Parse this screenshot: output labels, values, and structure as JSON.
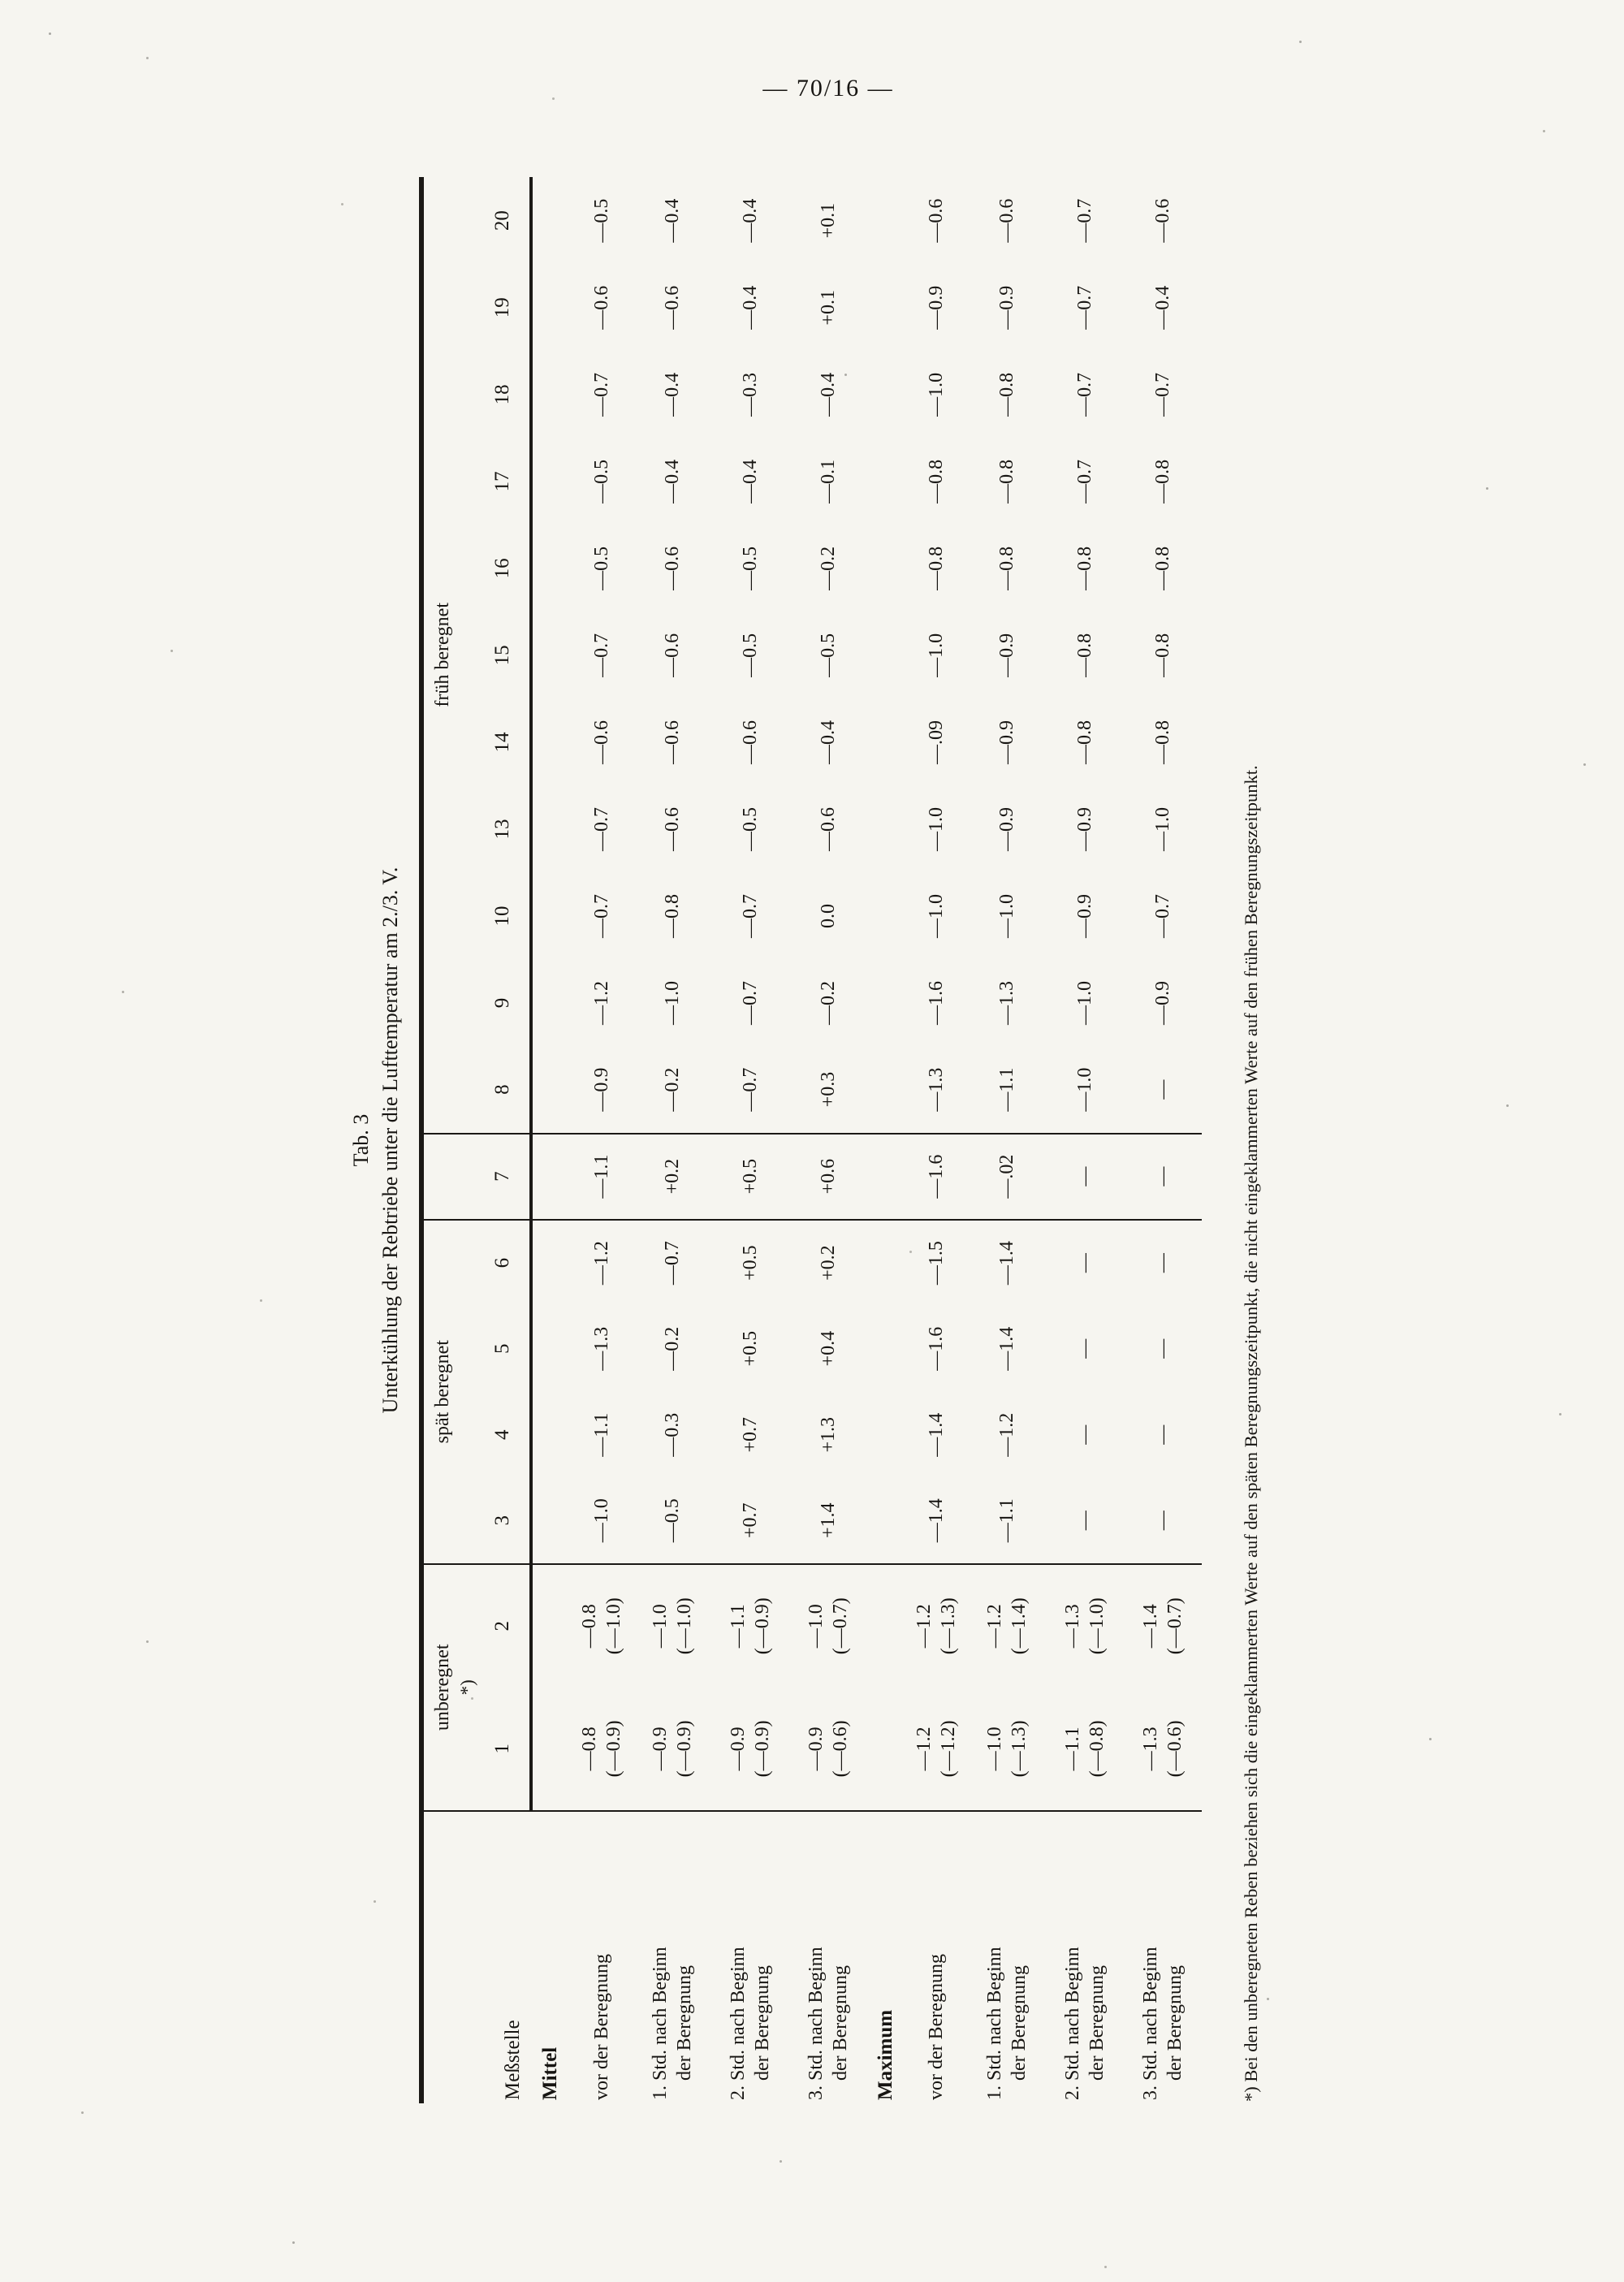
{
  "page": {
    "number": "— 70/16 —"
  },
  "table": {
    "title_line1": "Tab. 3",
    "title_line2": "Unterkühlung der Rebtriebe unter die Lufttemperatur am 2./3. V.",
    "corner_header": "Meßstelle",
    "groups": [
      {
        "label": "unberegnet",
        "note": "*)",
        "cols": [
          "1",
          "2"
        ]
      },
      {
        "label": "spät beregnet",
        "note": "",
        "cols": [
          "3",
          "4",
          "5",
          "6"
        ]
      },
      {
        "label": "",
        "note": "",
        "cols": [
          "7"
        ]
      },
      {
        "label": "früh beregnet",
        "note": "",
        "cols": [
          "8",
          "9",
          "10",
          "13",
          "14",
          "15",
          "16",
          "17",
          "18",
          "19",
          "20"
        ]
      }
    ],
    "sections": [
      {
        "heading": "Mittel",
        "rows": [
          {
            "label": [
              "vor der Beregnung"
            ],
            "values": [
              [
                "—0.8",
                "(—0.9)"
              ],
              [
                "—0.8",
                "(—1.0)"
              ],
              [
                "—1.0"
              ],
              [
                "—1.1"
              ],
              [
                "—1.3"
              ],
              [
                "—1.2"
              ],
              [
                "—1.1"
              ],
              [
                "—0.9"
              ],
              [
                "—1.2"
              ],
              [
                "—0.7"
              ],
              [
                "—0.7"
              ],
              [
                "—0.6"
              ],
              [
                "—0.7"
              ],
              [
                "—0.5"
              ],
              [
                "—0.5"
              ],
              [
                "—0.7"
              ],
              [
                "—0.6"
              ],
              [
                "—0.5"
              ]
            ]
          },
          {
            "label": [
              "1. Std. nach Beginn",
              "der Beregnung"
            ],
            "values": [
              [
                "—0.9",
                "(—0.9)"
              ],
              [
                "—1.0",
                "(—1.0)"
              ],
              [
                "—0.5"
              ],
              [
                "—0.3"
              ],
              [
                "—0.2"
              ],
              [
                "—0.7"
              ],
              [
                "+0.2"
              ],
              [
                "—0.2"
              ],
              [
                "—1.0"
              ],
              [
                "—0.8"
              ],
              [
                "—0.6"
              ],
              [
                "—0.6"
              ],
              [
                "—0.6"
              ],
              [
                "—0.6"
              ],
              [
                "—0.4"
              ],
              [
                "—0.4"
              ],
              [
                "—0.6"
              ],
              [
                "—0.4"
              ]
            ]
          },
          {
            "label": [
              "2. Std. nach Beginn",
              "der Beregnung"
            ],
            "values": [
              [
                "—0.9",
                "(—0.9)"
              ],
              [
                "—1.1",
                "(—0.9)"
              ],
              [
                "+0.7"
              ],
              [
                "+0.7"
              ],
              [
                "+0.5"
              ],
              [
                "+0.5"
              ],
              [
                "+0.5"
              ],
              [
                "—0.7"
              ],
              [
                "—0.7"
              ],
              [
                "—0.7"
              ],
              [
                "—0.5"
              ],
              [
                "—0.6"
              ],
              [
                "—0.5"
              ],
              [
                "—0.5"
              ],
              [
                "—0.4"
              ],
              [
                "—0.3"
              ],
              [
                "—0.4"
              ],
              [
                "—0.4"
              ]
            ]
          },
          {
            "label": [
              "3. Std. nach Beginn",
              "der Beregnung"
            ],
            "values": [
              [
                "—0.9",
                "(—0.6)"
              ],
              [
                "—1.0",
                "(—0.7)"
              ],
              [
                "+1.4"
              ],
              [
                "+1.3"
              ],
              [
                "+0.4"
              ],
              [
                "+0.2"
              ],
              [
                "+0.6"
              ],
              [
                "+0.3"
              ],
              [
                "—0.2"
              ],
              [
                "0.0"
              ],
              [
                "—0.6"
              ],
              [
                "—0.4"
              ],
              [
                "—0.5"
              ],
              [
                "—0.2"
              ],
              [
                "—0.1"
              ],
              [
                "—0.4"
              ],
              [
                "+0.1"
              ],
              [
                "+0.1"
              ]
            ]
          }
        ]
      },
      {
        "heading": "Maximum",
        "rows": [
          {
            "label": [
              "vor der Beregnung"
            ],
            "values": [
              [
                "—1.2",
                "(—1.2)"
              ],
              [
                "—1.2",
                "(—1.3)"
              ],
              [
                "—1.4"
              ],
              [
                "—1.4"
              ],
              [
                "—1.6"
              ],
              [
                "—1.5"
              ],
              [
                "—1.6"
              ],
              [
                "—1.3"
              ],
              [
                "—1.6"
              ],
              [
                "—1.0"
              ],
              [
                "—1.0"
              ],
              [
                "—.09"
              ],
              [
                "—1.0"
              ],
              [
                "—0.8"
              ],
              [
                "—0.8"
              ],
              [
                "—1.0"
              ],
              [
                "—0.9"
              ],
              [
                "—0.6"
              ]
            ]
          },
          {
            "label": [
              "1. Std. nach Beginn",
              "der Beregnung"
            ],
            "values": [
              [
                "—1.0",
                "(—1.3)"
              ],
              [
                "—1.2",
                "(—1.4)"
              ],
              [
                "—1.1"
              ],
              [
                "—1.2"
              ],
              [
                "—1.4"
              ],
              [
                "—1.4"
              ],
              [
                "—.02"
              ],
              [
                "—1.1"
              ],
              [
                "—1.3"
              ],
              [
                "—1.0"
              ],
              [
                "—0.9"
              ],
              [
                "—0.9"
              ],
              [
                "—0.9"
              ],
              [
                "—0.8"
              ],
              [
                "—0.8"
              ],
              [
                "—0.8"
              ],
              [
                "—0.9"
              ],
              [
                "—0.6"
              ]
            ]
          },
          {
            "label": [
              "2. Std. nach Beginn",
              "der Beregnung"
            ],
            "values": [
              [
                "—1.1",
                "(—0.8)"
              ],
              [
                "—1.3",
                "(—1.0)"
              ],
              [
                "—"
              ],
              [
                "—"
              ],
              [
                "—"
              ],
              [
                "—"
              ],
              [
                "—"
              ],
              [
                "—1.0"
              ],
              [
                "—1.0"
              ],
              [
                "—0.9"
              ],
              [
                "—0.9"
              ],
              [
                "—0.8"
              ],
              [
                "—0.8"
              ],
              [
                "—0.8"
              ],
              [
                "—0.7"
              ],
              [
                "—0.7"
              ],
              [
                "—0.7"
              ],
              [
                "—0.7"
              ]
            ]
          },
          {
            "label": [
              "3. Std. nach Beginn",
              "der Beregnung"
            ],
            "values": [
              [
                "—1.3",
                "(—0.6)"
              ],
              [
                "—1.4",
                "(—0.7)"
              ],
              [
                "—"
              ],
              [
                "—"
              ],
              [
                "—"
              ],
              [
                "—"
              ],
              [
                "—"
              ],
              [
                "—"
              ],
              [
                "—0.9"
              ],
              [
                "—0.7"
              ],
              [
                "—1.0"
              ],
              [
                "—0.8"
              ],
              [
                "—0.8"
              ],
              [
                "—0.8"
              ],
              [
                "—0.8"
              ],
              [
                "—0.7"
              ],
              [
                "—0.4"
              ],
              [
                "—0.6"
              ]
            ]
          }
        ]
      }
    ],
    "footnote": "*) Bei den unberegneten Reben beziehen sich die eingeklammerten Werte auf den späten Beregnungszeitpunkt, die nicht eingeklammerten Werte auf den frühen Beregnungszeitpunkt."
  }
}
